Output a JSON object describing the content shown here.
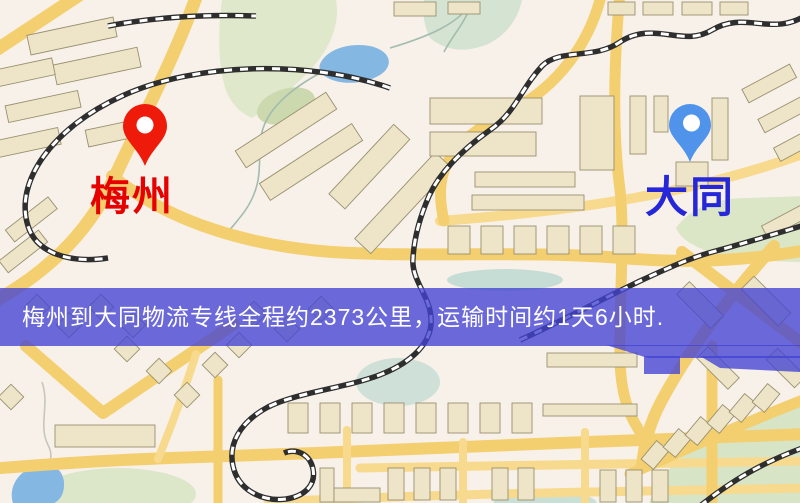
{
  "markers": {
    "origin": {
      "label": "梅州",
      "pin_color": "#ee1a0a",
      "label_color": "#e60000"
    },
    "destination": {
      "label": "大同",
      "pin_color": "#4f93ea",
      "label_color": "#2727da"
    }
  },
  "banner": {
    "text": "梅州到大同物流专线全程约2373公里，运输时间约1天6小时.",
    "bg_color": "#4343d4",
    "text_color": "#ffffff"
  },
  "map_palette": {
    "background": "#f8f1ea",
    "road": "#f4cf6f",
    "building": "#eee4c8",
    "park": "#dde8ca",
    "water": "#84b7e1",
    "railway_dark": "#2e2e2e"
  }
}
